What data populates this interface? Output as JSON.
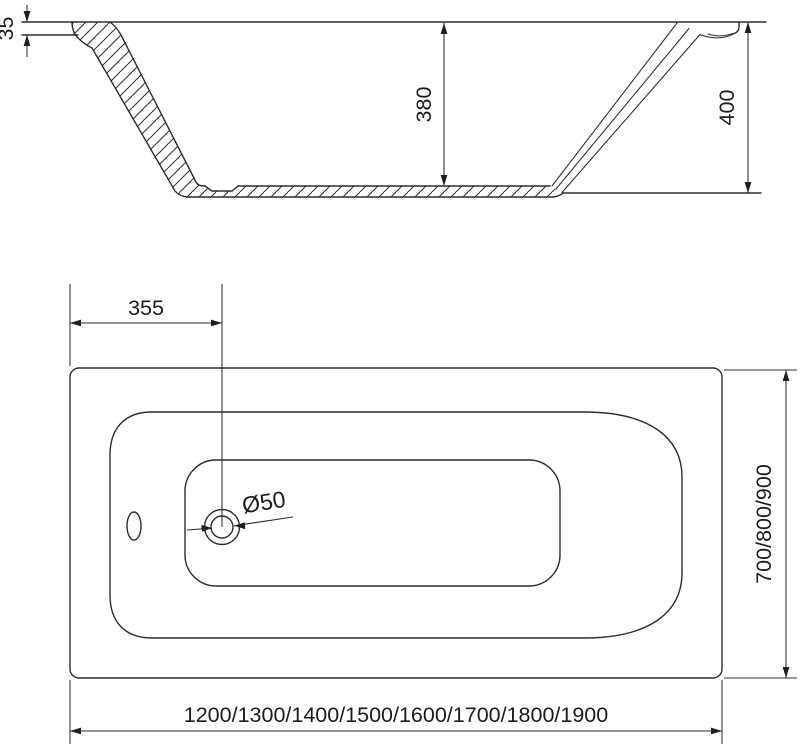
{
  "drawing": {
    "colors": {
      "line": "#2d2d2d",
      "text": "#1c1c1c",
      "background": "#ffffff"
    },
    "dims": {
      "rim_thickness": "35",
      "inner_depth": "380",
      "overall_height": "400",
      "drain_offset": "355",
      "drain_diameter": "Ø50",
      "width_options": "700/800/900",
      "length_options": "1200/1300/1400/1500/1600/1700/1800/1900"
    }
  }
}
